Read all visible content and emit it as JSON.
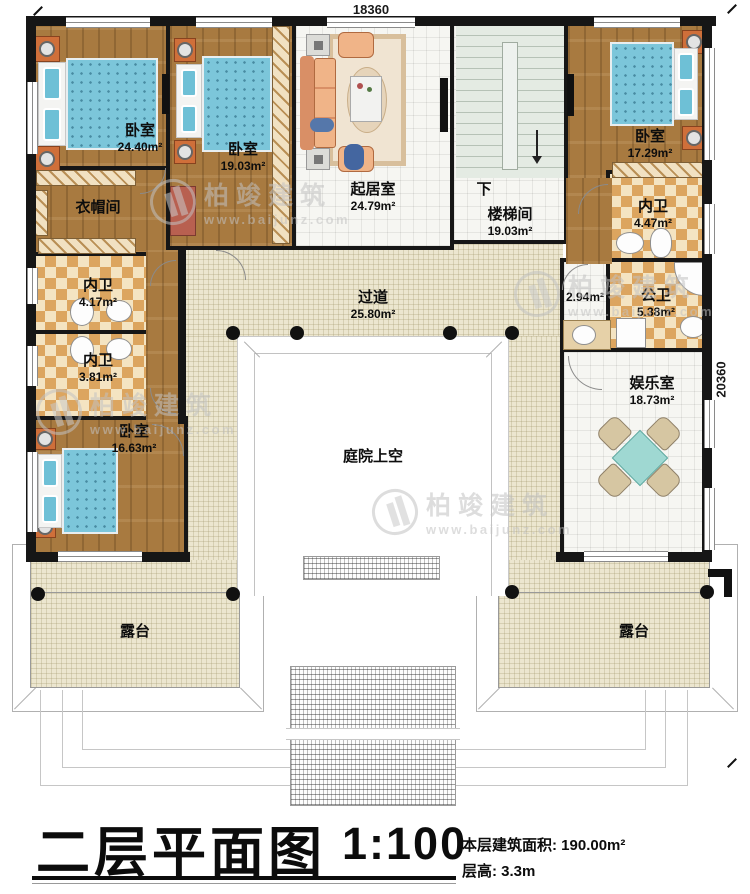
{
  "dimensions": {
    "top": "18360",
    "right": "20360"
  },
  "watermark": {
    "brand": "柏竣建筑",
    "url": "www.baijunz.com"
  },
  "rooms": {
    "bedroom1": {
      "name": "卧室",
      "area": "24.40m²"
    },
    "cloakroom": {
      "name": "衣帽间"
    },
    "bedroom2": {
      "name": "卧室",
      "area": "19.03m²"
    },
    "living": {
      "name": "起居室",
      "area": "24.79m²"
    },
    "stairwell": {
      "name": "楼梯间",
      "area": "19.03m²",
      "down": "下"
    },
    "bedroom3": {
      "name": "卧室",
      "area": "17.29m²"
    },
    "bath_right": {
      "name": "内卫",
      "area": "4.47m²"
    },
    "public_bath": {
      "name": "公卫",
      "area": "5.38m²"
    },
    "nook": {
      "area": "2.94m²"
    },
    "entertainment": {
      "name": "娱乐室",
      "area": "18.73m²"
    },
    "bath_left1": {
      "name": "内卫",
      "area": "4.17m²"
    },
    "bath_left2": {
      "name": "内卫",
      "area": "3.81m²"
    },
    "bedroom4": {
      "name": "卧室",
      "area": "16.63m²"
    },
    "corridor": {
      "name": "过道",
      "area": "25.80m²"
    },
    "courtyard": {
      "name": "庭院上空"
    },
    "terrace_left": {
      "name": "露台"
    },
    "terrace_right": {
      "name": "露台"
    }
  },
  "title": {
    "main": "二层平面图",
    "scale": "1:100",
    "area_label": "本层建筑面积: 190.00m²",
    "floor_height": "层高: 3.3m"
  },
  "colors": {
    "wall_black": "#161616",
    "wood_floor": "#a87a40",
    "bed_blue": "#7cc6da",
    "bath_checker": "#dca55f",
    "corridor_cream": "#ece6cf",
    "table_teal": "#9fd8d2"
  }
}
